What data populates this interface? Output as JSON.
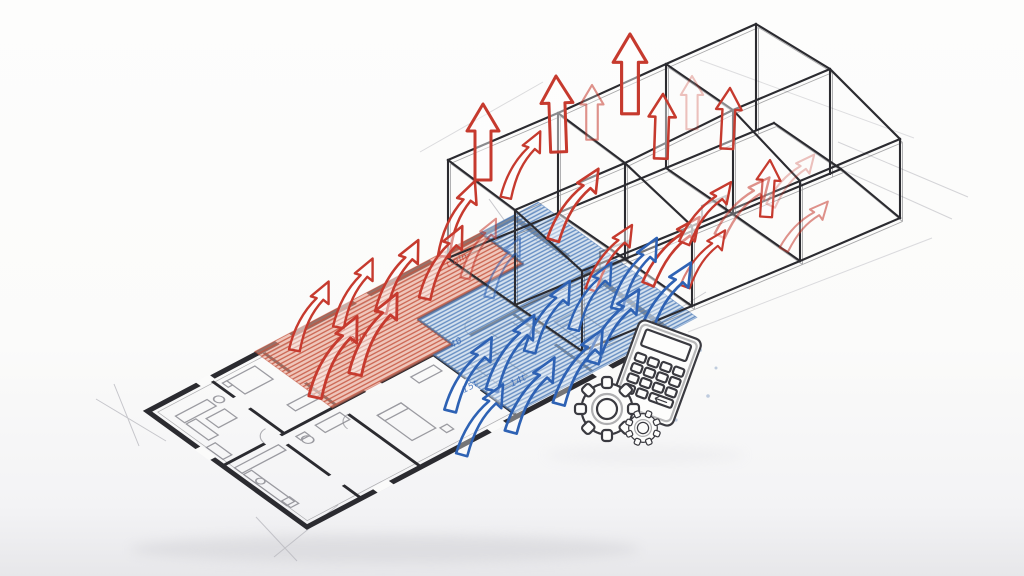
{
  "scene": {
    "type": "hand-drawn architectural concept sketch",
    "description": "Isometric floor plan with a warm (red) zone and a cool (blue) zone, airflow arrows rising into a wireframe room structure above, with a calculator and gears motif",
    "background": "#fbfbfa"
  },
  "colors": {
    "heat": "#c63a2e",
    "heat_fill": "#e8a18e",
    "heat_hatch": "#c4533d",
    "cool": "#2e62b4",
    "cool_fill": "#b9cfe7",
    "cool_hatch": "#4a79b8",
    "ink": "#2b2b30",
    "ink_soft": "#3a3a40",
    "furniture": "#8b8b92",
    "construction": "#b9b9bf",
    "background": "#fbfbfa",
    "shadow": "#c9c9ce",
    "paper_edge": "#e7e7ea"
  },
  "zones": [
    {
      "id": "warm-zone",
      "kind": "warm"
    },
    {
      "id": "cool-zone",
      "kind": "cool"
    }
  ],
  "annotations": [
    {
      "text": "t·ein",
      "zone": "warm"
    },
    {
      "text": "θ·m",
      "zone": "warm"
    },
    {
      "text": "4θ",
      "zone": "cool"
    },
    {
      "text": "15t",
      "zone": "cool"
    },
    {
      "text": "14t",
      "zone": "cool"
    }
  ],
  "icons": [
    {
      "name": "calculator-icon"
    },
    {
      "name": "gear-large-icon"
    },
    {
      "name": "gear-small-icon"
    }
  ]
}
